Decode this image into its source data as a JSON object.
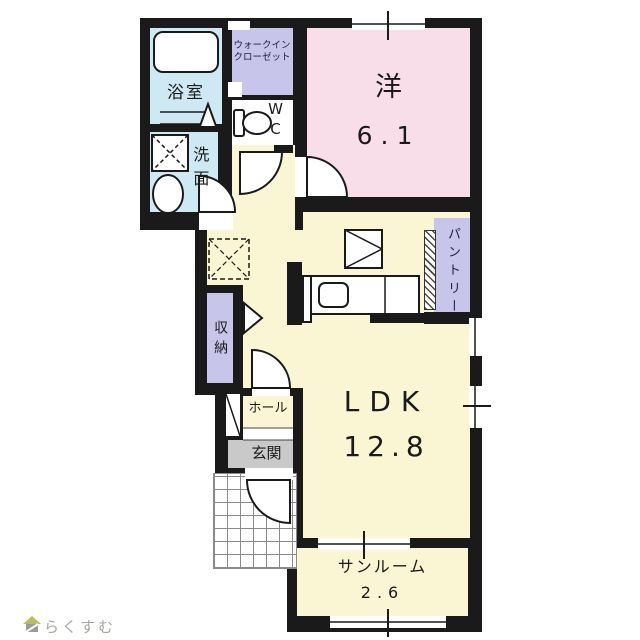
{
  "meta": {
    "type": "apartment-floorplan"
  },
  "floorplan": {
    "rooms": {
      "bathroom": {
        "label": "浴室"
      },
      "walk_in_closet": {
        "line1": "ウォークイン",
        "line2": "クローゼット"
      },
      "toilet": {
        "line1": "W",
        "line2": "C"
      },
      "washroom": {
        "label": "洗面"
      },
      "western_room": {
        "label": "洋",
        "size": "6.1"
      },
      "pantry": {
        "label": "パントリー"
      },
      "storage": {
        "label": "収納"
      },
      "hall": {
        "label": "ホール"
      },
      "entrance": {
        "label": "玄関"
      },
      "ldk": {
        "label": "LDK",
        "size": "12.8"
      },
      "sunroom": {
        "label": "サンルーム",
        "size": "2.6"
      }
    },
    "colors": {
      "wall": "#1a1a1a",
      "wet_area": "#cfe9f4",
      "closet": "#c8c5ea",
      "bedroom": "#f8dee9",
      "living": "#faf6d3",
      "entrance_floor": "#c9c9c9"
    },
    "fixtures": [
      "bathtub",
      "washing-machine-space",
      "wash-basin",
      "toilet",
      "refrigerator-space",
      "kitchen-counter",
      "sink",
      "shoe-cabinet",
      "porch-tiles",
      "entry-door",
      "room-doors",
      "windows"
    ]
  },
  "footer": {
    "logo_text": "らくすむ"
  }
}
